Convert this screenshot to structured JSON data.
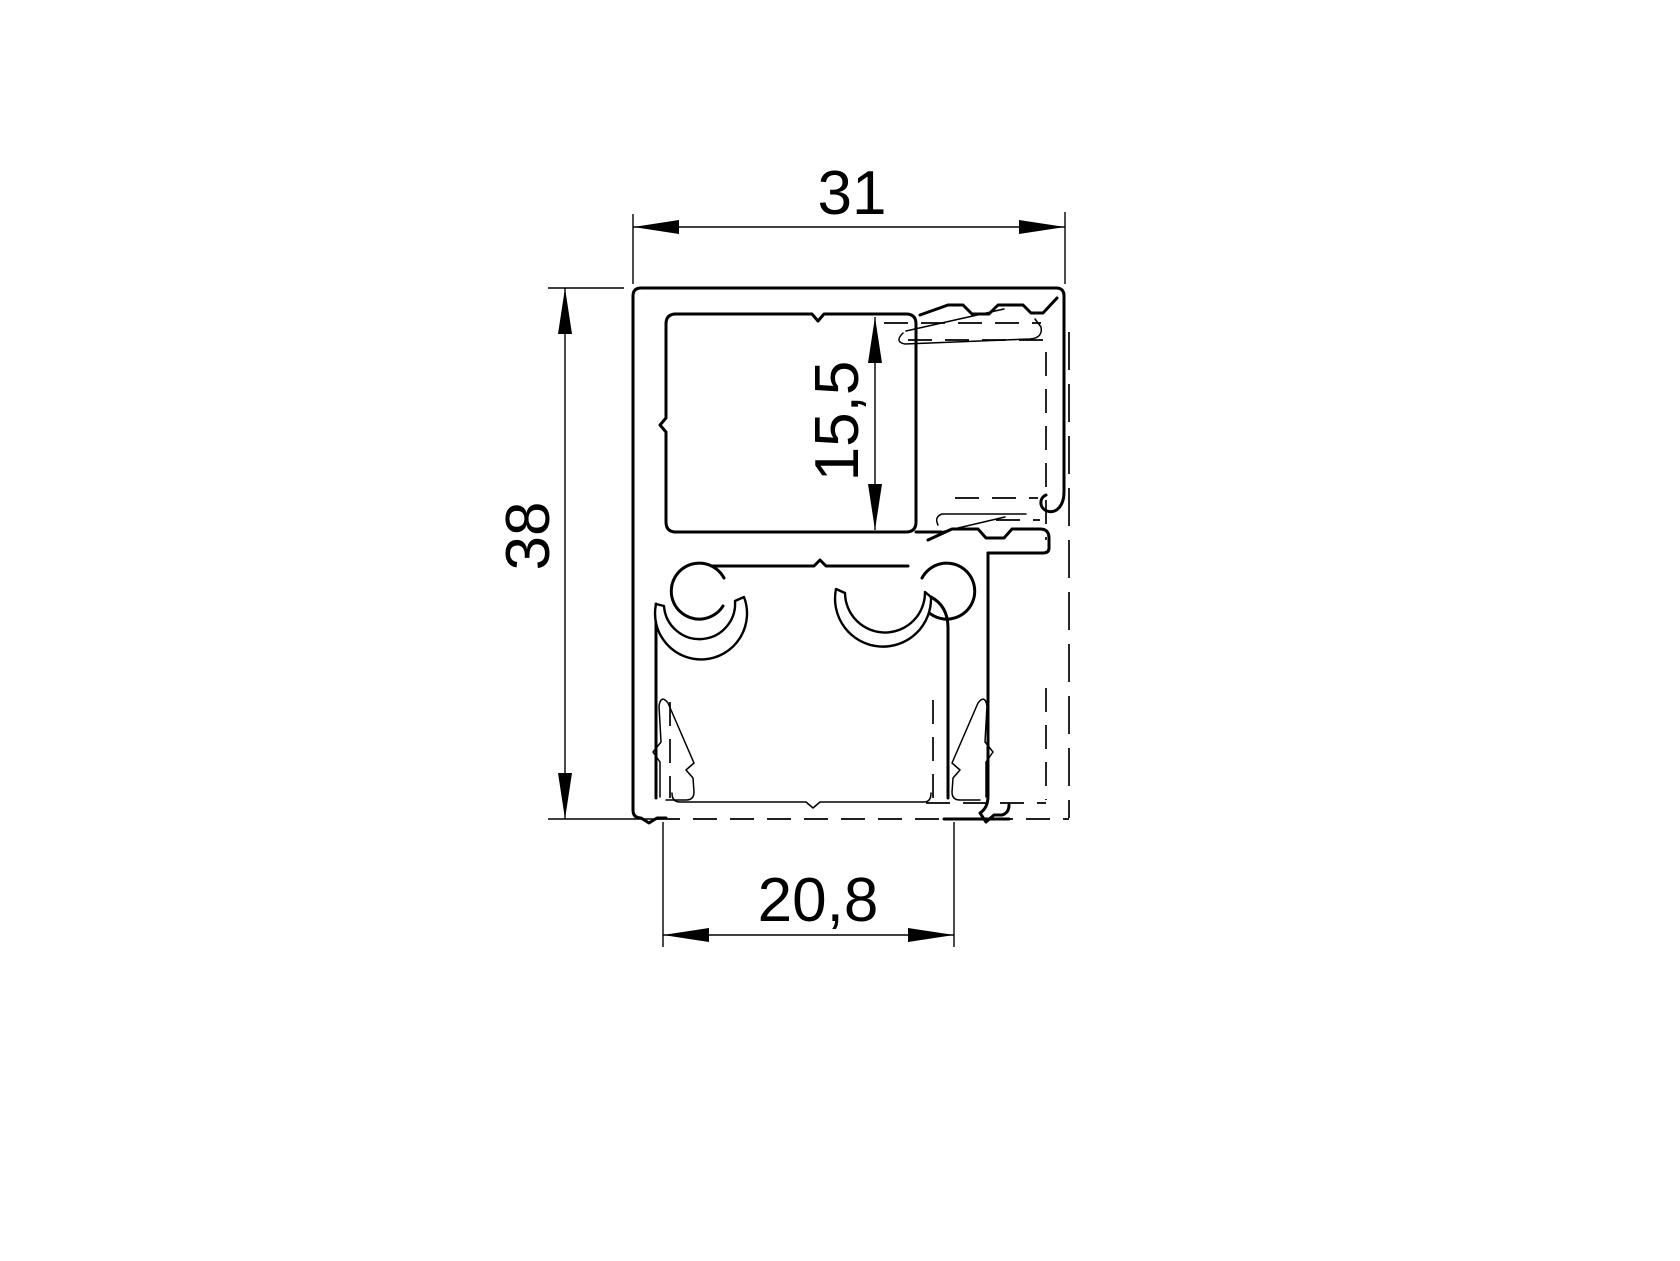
{
  "drawing": {
    "title": "aluminium-profile-cross-section",
    "background_color": "#ffffff",
    "line_color": "#000000",
    "decimal_style": "comma",
    "dimensions": {
      "overall_width": {
        "label": "31",
        "orientation": "horizontal",
        "position": "top"
      },
      "overall_height": {
        "label": "38",
        "orientation": "vertical",
        "position": "left"
      },
      "cavity_height": {
        "label": "15,5",
        "orientation": "vertical",
        "position": "center"
      },
      "bottom_channel_width": {
        "label": "20,8",
        "orientation": "horizontal",
        "position": "bottom"
      }
    }
  }
}
